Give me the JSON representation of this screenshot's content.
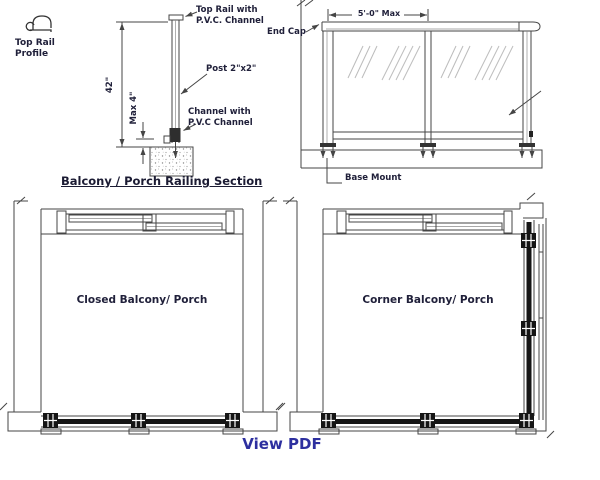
{
  "page": {
    "background": "#ffffff",
    "line_color": "#454545",
    "label_color": "#20203a",
    "link_color": "#2d2f9f"
  },
  "profile_key": {
    "label": "Top Rail Profile"
  },
  "section": {
    "caption": "Balcony / Porch Railing Section",
    "labels": {
      "top_rail": "Top Rail with P.V.C. Channel",
      "post": "Post 2\"x2\"",
      "channel": "Channel with P.V.C Channel"
    },
    "dims": {
      "height": "42\"",
      "gap": "Max 4\""
    }
  },
  "elevation": {
    "dims": {
      "bay_width": "5'-0\" Max"
    },
    "labels": {
      "end_cap": "End Cap",
      "base_mount": "Base Mount"
    }
  },
  "plans": {
    "closed": {
      "label": "Closed Balcony/ Porch"
    },
    "corner": {
      "label": "Corner Balcony/ Porch"
    }
  },
  "footer": {
    "view_pdf": "View PDF"
  }
}
